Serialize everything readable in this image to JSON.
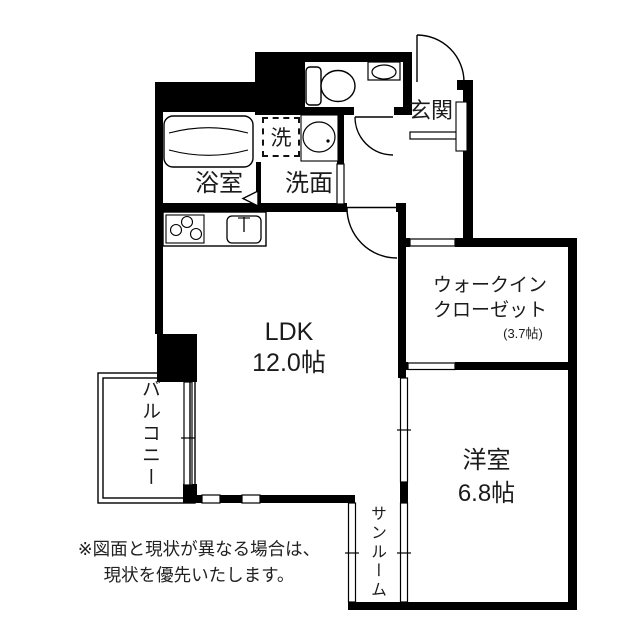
{
  "floorplan": {
    "title": "apartment-floor-plan",
    "rooms": {
      "genkan": {
        "label": "玄関"
      },
      "bathroom": {
        "label": "浴室"
      },
      "washroom": {
        "label": "洗面"
      },
      "laundry": {
        "label": "洗"
      },
      "ldk": {
        "label": "LDK",
        "area": "12.0帖"
      },
      "wic": {
        "label_line1": "ウォークイン",
        "label_line2": "クローゼット",
        "area": "(3.7帖)"
      },
      "western_room": {
        "label": "洋室",
        "area": "6.8帖"
      },
      "sunroom": {
        "label": "サンルーム"
      },
      "balcony": {
        "label": "バルコニー"
      }
    },
    "fixtures": [
      "bathtub",
      "toilet",
      "hand-wash-basin",
      "washbasin",
      "washing-machine-space",
      "kitchen-stove",
      "kitchen-sink",
      "shoe-cabinet",
      "entrance-door",
      "toilet-door",
      "ldk-door",
      "bathroom-folding-door",
      "balcony-railing",
      "sliding-windows"
    ],
    "note": {
      "line1": "※図面と現状が異なる場合は、",
      "line2": "現状を優先いたします。"
    },
    "colors": {
      "wall": "#000000",
      "background": "#ffffff",
      "text": "#1b1b1b"
    }
  }
}
